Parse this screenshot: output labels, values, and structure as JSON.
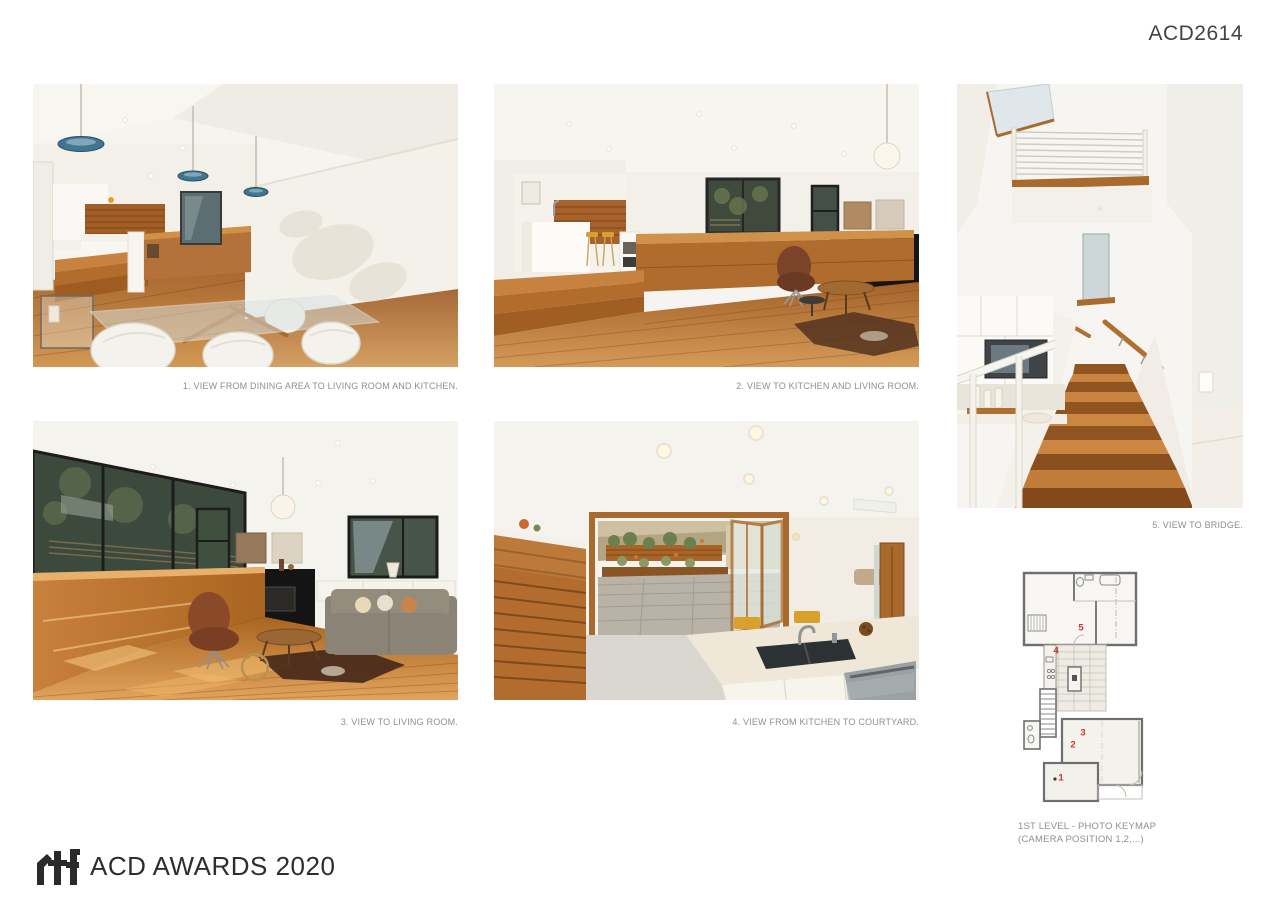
{
  "board": {
    "id": "ACD2614"
  },
  "photos": [
    {
      "label": "1",
      "caption": "1. VIEW FROM DINING AREA TO LIVING ROOM AND KITCHEN."
    },
    {
      "label": "2",
      "caption": "2. VIEW TO KITCHEN AND LIVING ROOM."
    },
    {
      "label": "3",
      "caption": "3. VIEW TO LIVING ROOM."
    },
    {
      "label": "4",
      "caption": "4. VIEW FROM KITCHEN TO COURTYARD."
    },
    {
      "label": "5",
      "caption": "5. VIEW TO BRIDGE."
    }
  ],
  "keymap": {
    "caption_line1": "1ST LEVEL - PHOTO KEYMAP",
    "caption_line2": "(CAMERA POSITION 1,2,...)",
    "marker_color": "#c9392f",
    "markers": [
      {
        "label": "1"
      },
      {
        "label": "2"
      },
      {
        "label": "3"
      },
      {
        "label": "4"
      },
      {
        "label": "5"
      }
    ]
  },
  "footer": {
    "logo_mark": "rtf",
    "logo_text": "ACD AWARDS 2020"
  },
  "palette": {
    "wood": "#b5713a",
    "wood_dark": "#8a5424",
    "wall_white": "#f5f3ee",
    "pendant_blue": "#41768f",
    "stool_yellow": "#d9a02b",
    "marker_red": "#c9392f",
    "caption_gray": "#8f8f8f",
    "logo_dark": "#2e2e30"
  }
}
